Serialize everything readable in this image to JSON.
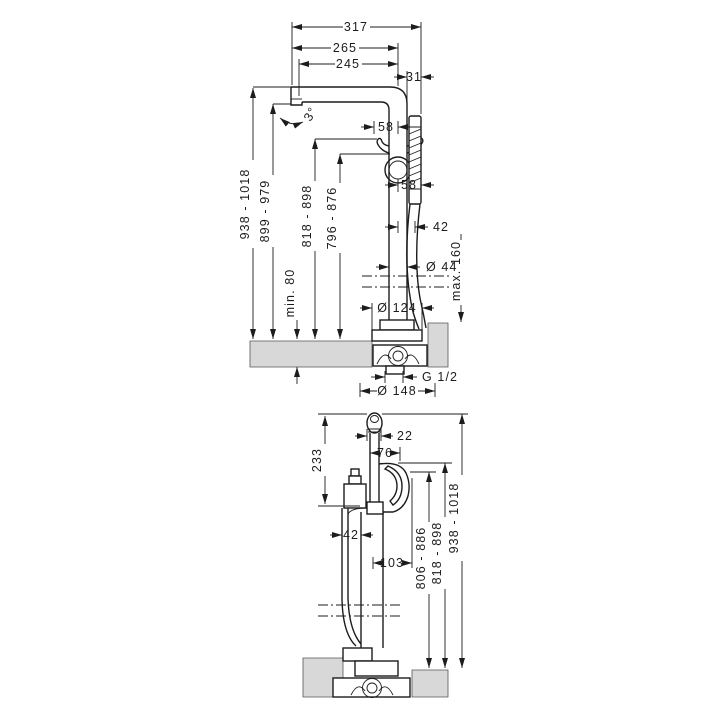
{
  "drawing": {
    "side_view": {
      "label": "side view",
      "dims": {
        "total_projection": "317",
        "spout_reach_outer": "265",
        "spout_reach_inner": "245",
        "spout_angle": "3°",
        "handshower_offset": "31",
        "holder_to_axis": "58",
        "axis_to_handshower": "58",
        "hose_offset": "42",
        "pipe_diameter": "Ø 44",
        "floor_max": "max. 160",
        "floor_min": "min. 80",
        "height_total": "938 - 1018",
        "height_spout_outlet": "899 - 979",
        "height_holder": "818 - 898",
        "height_loop": "796 - 876",
        "escutcheon_diameter": "Ø 124",
        "thread": "G 1/2",
        "base_diameter": "Ø 148"
      }
    },
    "front_view": {
      "label": "front view",
      "dims": {
        "handshower_width": "22",
        "spout_offset": "76",
        "handshower_length": "233",
        "hose_offset": "42",
        "spout_projection": "103",
        "height_outlet": "806 - 886",
        "height_spout_top": "818 - 898",
        "height_total": "938 - 1018"
      }
    }
  }
}
